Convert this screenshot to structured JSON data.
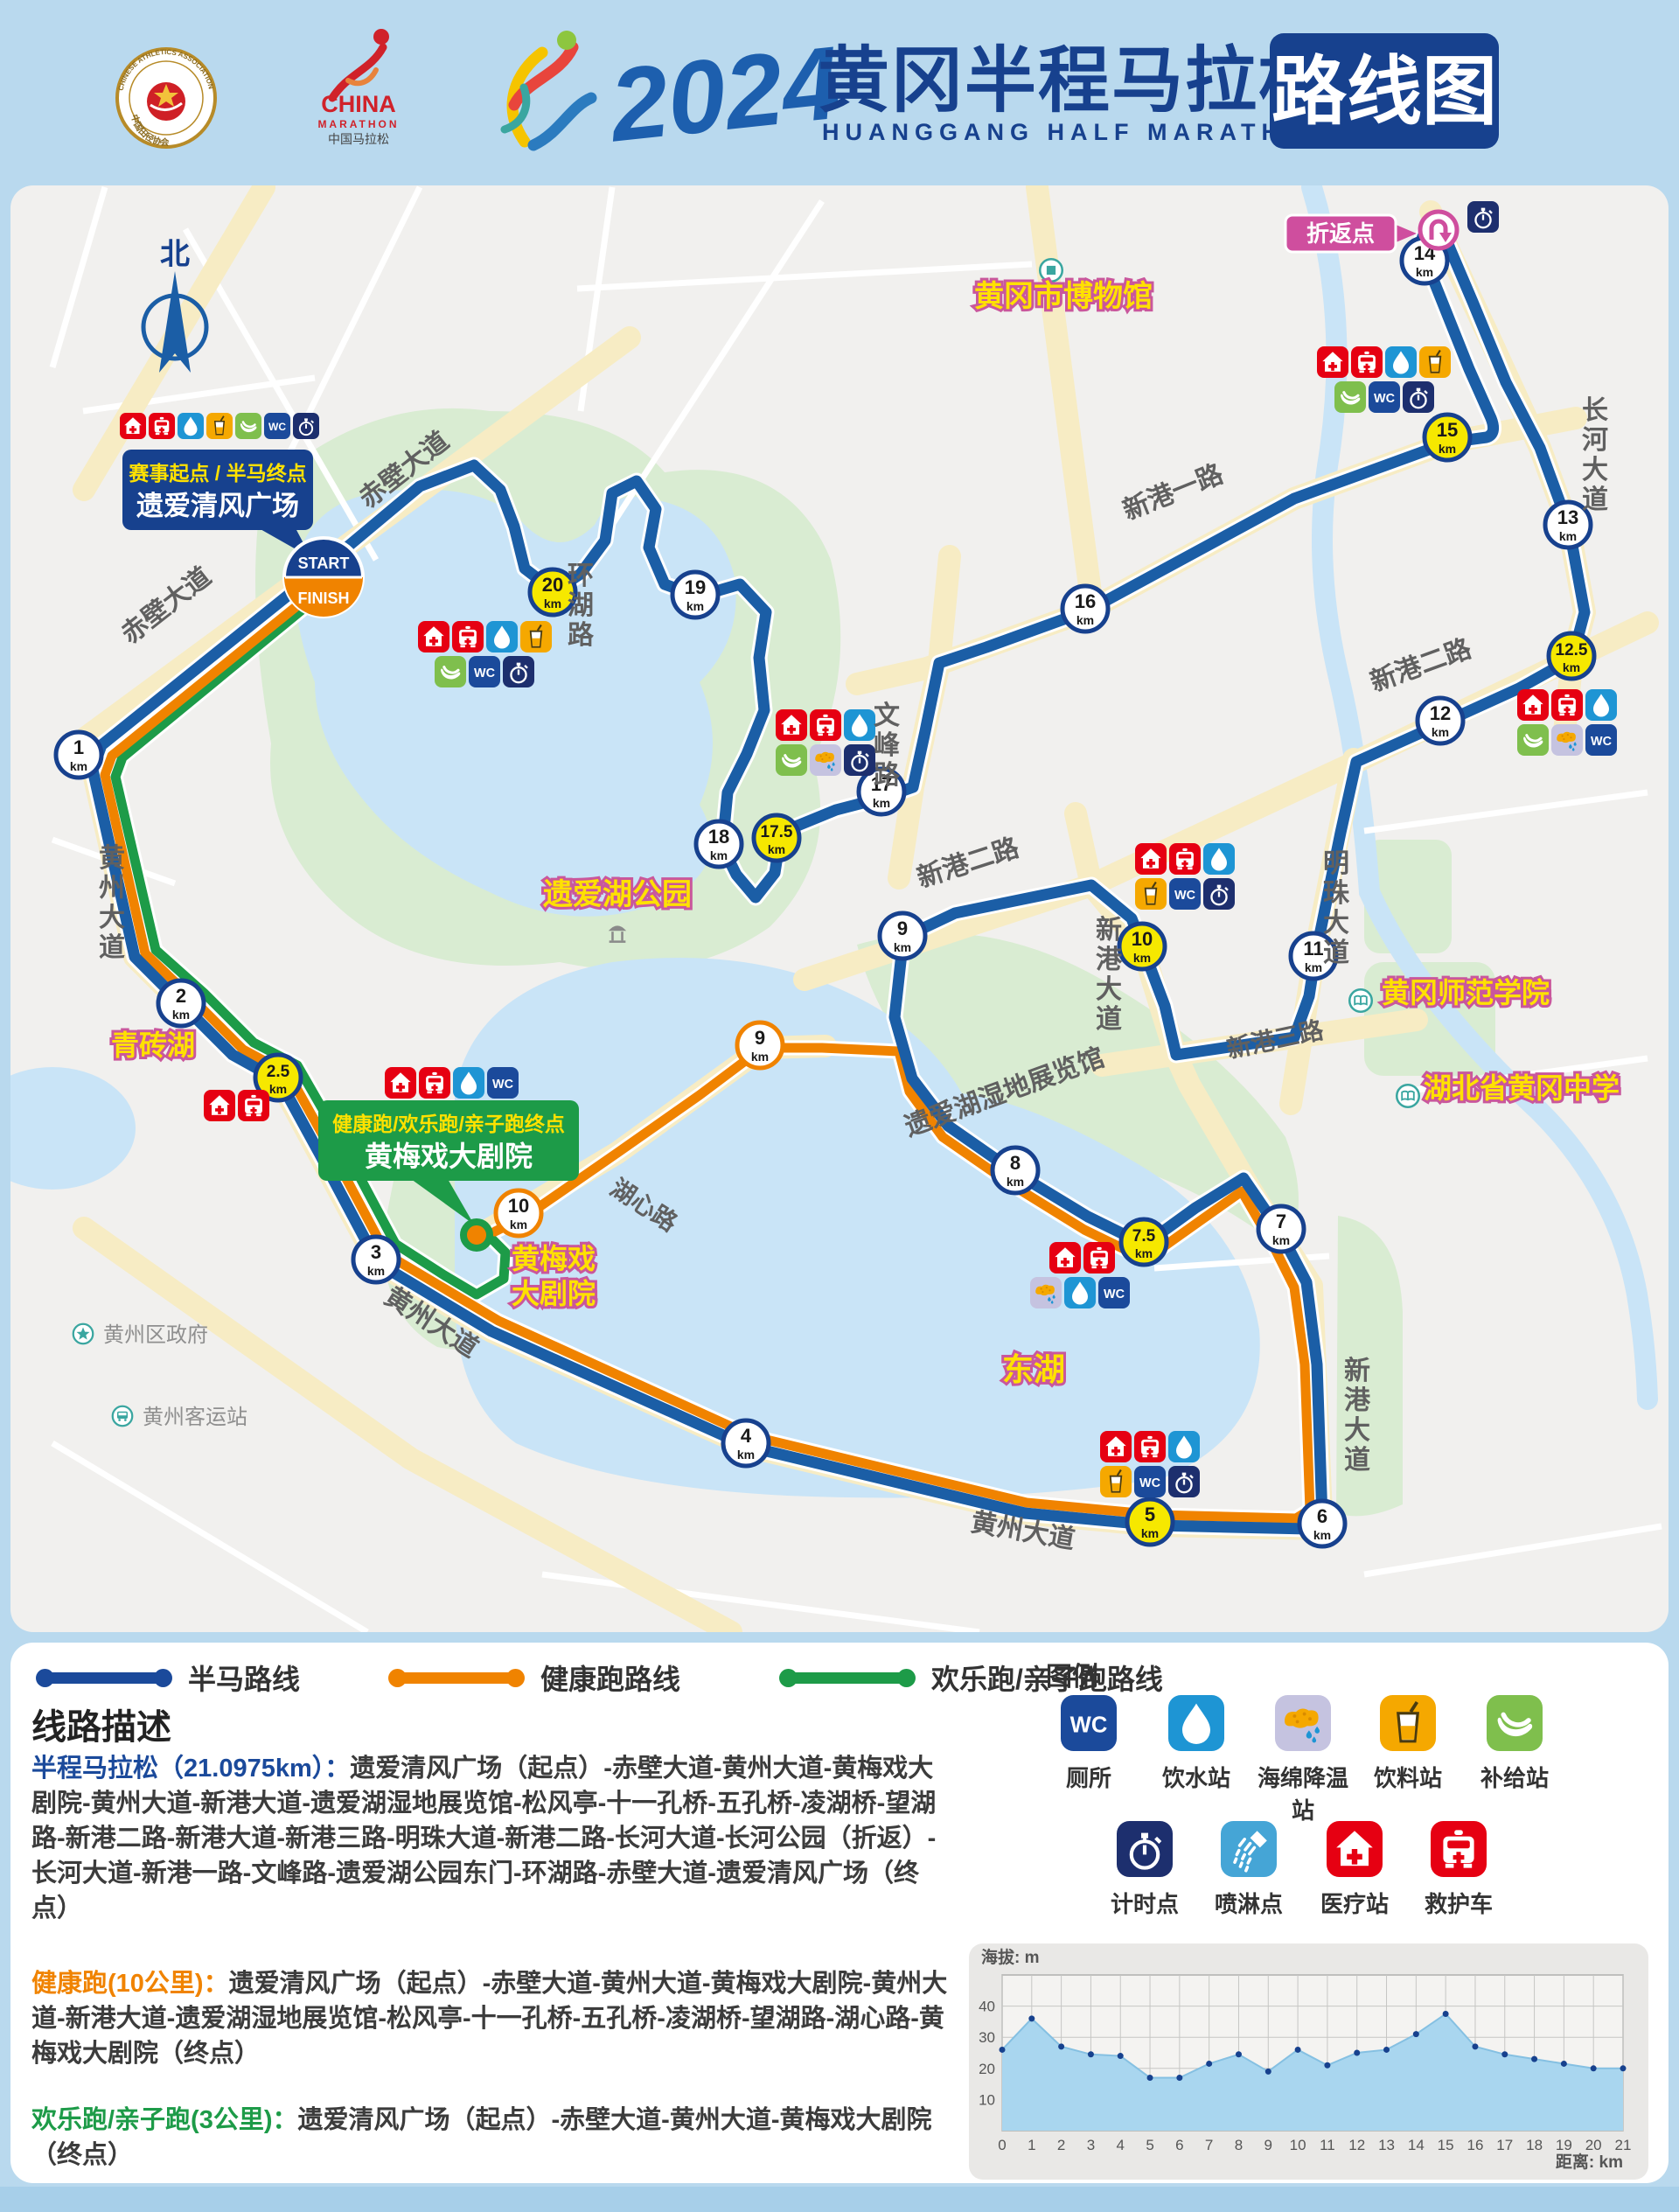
{
  "header": {
    "caa": {
      "top": "CHINESE ATHLETICS ASSOCIATION",
      "bottom": "中国田径协会"
    },
    "cm": {
      "l1": "CHINA",
      "l2": "MARATHON",
      "l3": "中国马拉松"
    },
    "year": "2024",
    "title_cn": "黄冈半程马拉松",
    "title_en": "HUANGGANG HALF MARATHON",
    "badge": "路线图"
  },
  "icons": {
    "wc_label": "WC"
  },
  "map": {
    "compass": "北",
    "start_label": {
      "line1": "赛事起点 / 半马终点",
      "line2": "遗爱清风广场"
    },
    "start_badge": {
      "top": "START",
      "bottom": "FINISH"
    },
    "turnaround_label": "折返点",
    "finish_label": {
      "line1": "健康跑/欢乐跑/亲子跑终点",
      "line2": "黄梅戏大剧院"
    },
    "km_unit": "km",
    "marker_styles": {
      "white": {
        "fill": "#ffffff",
        "stroke": "#17418e"
      },
      "yellow": {
        "fill": "#f6e800",
        "stroke": "#17418e"
      },
      "orange": {
        "fill": "#ffffff",
        "stroke": "#f08300"
      }
    },
    "km_markers": [
      {
        "num": "1",
        "x": 90,
        "y": 863,
        "style": "white"
      },
      {
        "num": "2",
        "x": 207,
        "y": 1147,
        "style": "white"
      },
      {
        "num": "2.5",
        "x": 318,
        "y": 1232,
        "style": "yellow"
      },
      {
        "num": "3",
        "x": 430,
        "y": 1440,
        "style": "white"
      },
      {
        "num": "4",
        "x": 853,
        "y": 1650,
        "style": "white"
      },
      {
        "num": "5",
        "x": 1315,
        "y": 1740,
        "style": "yellow"
      },
      {
        "num": "6",
        "x": 1512,
        "y": 1742,
        "style": "white"
      },
      {
        "num": "7",
        "x": 1465,
        "y": 1405,
        "style": "white"
      },
      {
        "num": "7.5",
        "x": 1308,
        "y": 1420,
        "style": "yellow"
      },
      {
        "num": "8",
        "x": 1161,
        "y": 1338,
        "style": "white"
      },
      {
        "num": "9",
        "x": 1032,
        "y": 1070,
        "style": "white"
      },
      {
        "num": "9",
        "x": 869,
        "y": 1195,
        "style": "orange"
      },
      {
        "num": "10",
        "x": 1306,
        "y": 1082,
        "style": "yellow"
      },
      {
        "num": "10",
        "x": 593,
        "y": 1387,
        "style": "orange"
      },
      {
        "num": "11",
        "x": 1502,
        "y": 1093,
        "style": "white"
      },
      {
        "num": "12",
        "x": 1647,
        "y": 824,
        "style": "white"
      },
      {
        "num": "12.5",
        "x": 1797,
        "y": 750,
        "style": "yellow"
      },
      {
        "num": "13",
        "x": 1793,
        "y": 600,
        "style": "white"
      },
      {
        "num": "14",
        "x": 1629,
        "y": 298,
        "style": "white"
      },
      {
        "num": "15",
        "x": 1655,
        "y": 500,
        "style": "yellow"
      },
      {
        "num": "16",
        "x": 1241,
        "y": 696,
        "style": "white"
      },
      {
        "num": "17",
        "x": 1008,
        "y": 905,
        "style": "white"
      },
      {
        "num": "17.5",
        "x": 888,
        "y": 958,
        "style": "yellow"
      },
      {
        "num": "18",
        "x": 822,
        "y": 965,
        "style": "white"
      },
      {
        "num": "19",
        "x": 795,
        "y": 680,
        "style": "white"
      },
      {
        "num": "20",
        "x": 632,
        "y": 677,
        "style": "yellow"
      }
    ],
    "clusters": [
      {
        "x": 137,
        "y": 472,
        "size": 30,
        "rows": [
          {
            "dx": 0,
            "icons": [
              "medical",
              "ambulance",
              "water",
              "drink",
              "banana",
              "wc",
              "timer"
            ]
          }
        ]
      },
      {
        "x": 478,
        "y": 710,
        "rows": [
          {
            "dx": 0,
            "icons": [
              "medical",
              "ambulance",
              "water",
              "drink"
            ]
          },
          {
            "dx": 19,
            "icons": [
              "banana",
              "wc",
              "timer"
            ]
          }
        ]
      },
      {
        "x": 887,
        "y": 811,
        "rows": [
          {
            "dx": 0,
            "icons": [
              "medical",
              "ambulance",
              "water"
            ]
          },
          {
            "dx": 0,
            "icons": [
              "banana",
              "sponge",
              "timer"
            ]
          }
        ]
      },
      {
        "x": 1506,
        "y": 396,
        "rows": [
          {
            "dx": 0,
            "icons": [
              "medical",
              "ambulance",
              "water",
              "drink"
            ]
          },
          {
            "dx": 20,
            "icons": [
              "banana",
              "wc",
              "timer"
            ]
          }
        ]
      },
      {
        "x": 1735,
        "y": 788,
        "rows": [
          {
            "dx": 0,
            "icons": [
              "medical",
              "ambulance",
              "water"
            ]
          },
          {
            "dx": 0,
            "icons": [
              "banana",
              "sponge",
              "wc"
            ]
          }
        ]
      },
      {
        "x": 1298,
        "y": 964,
        "rows": [
          {
            "dx": 0,
            "icons": [
              "medical",
              "ambulance",
              "water"
            ]
          },
          {
            "dx": 0,
            "icons": [
              "drink",
              "wc",
              "timer"
            ]
          }
        ]
      },
      {
        "x": 1200,
        "y": 1420,
        "rows": [
          {
            "dx": 0,
            "icons": [
              "medical",
              "ambulance"
            ]
          },
          {
            "dx": -22,
            "icons": [
              "sponge",
              "water",
              "wc"
            ]
          }
        ]
      },
      {
        "x": 1258,
        "y": 1636,
        "rows": [
          {
            "dx": 0,
            "icons": [
              "medical",
              "ambulance",
              "water"
            ]
          },
          {
            "dx": 0,
            "icons": [
              "drink",
              "wc",
              "timer"
            ]
          }
        ]
      },
      {
        "x": 440,
        "y": 1220,
        "rows": [
          {
            "dx": 0,
            "icons": [
              "medical",
              "ambulance",
              "water",
              "wc"
            ]
          }
        ]
      },
      {
        "x": 233,
        "y": 1246,
        "rows": [
          {
            "dx": 0,
            "icons": [
              "medical",
              "ambulance"
            ]
          }
        ]
      },
      {
        "x": 1678,
        "y": 230,
        "rows": [
          {
            "dx": 0,
            "icons": [
              "timer"
            ]
          }
        ]
      }
    ],
    "road_labels": [
      {
        "t": "赤壁大道",
        "x": 468,
        "y": 545,
        "rot": -38,
        "s": 30
      },
      {
        "t": "赤壁大道",
        "x": 196,
        "y": 700,
        "rot": -38,
        "s": 30
      },
      {
        "t": "黄州大道",
        "x": 128,
        "y": 1042,
        "v": 1,
        "s": 30
      },
      {
        "t": "环湖路",
        "x": 664,
        "y": 702,
        "v": 1,
        "s": 30
      },
      {
        "t": "文峰路",
        "x": 1014,
        "y": 862,
        "v": 1,
        "s": 30
      },
      {
        "t": "新港一路",
        "x": 1345,
        "y": 572,
        "rot": -22,
        "s": 30
      },
      {
        "t": "长河大道",
        "x": 1824,
        "y": 530,
        "v": 1,
        "s": 30
      },
      {
        "t": "新港二路",
        "x": 1628,
        "y": 770,
        "rot": -20,
        "s": 30
      },
      {
        "t": "新港二路",
        "x": 1110,
        "y": 996,
        "rot": -18,
        "s": 30
      },
      {
        "t": "明珠大道",
        "x": 1528,
        "y": 1048,
        "v": 1,
        "s": 30
      },
      {
        "t": "新港三路",
        "x": 1460,
        "y": 1198,
        "rot": -12,
        "s": 28
      },
      {
        "t": "新港大道",
        "x": 1268,
        "y": 1124,
        "v": 1,
        "s": 30
      },
      {
        "t": "新港大道",
        "x": 1552,
        "y": 1628,
        "v": 1,
        "s": 30
      },
      {
        "t": "湖心路",
        "x": 731,
        "y": 1386,
        "rot": 33,
        "s": 28
      },
      {
        "t": "黄州大道",
        "x": 1168,
        "y": 1760,
        "rot": 10,
        "s": 30
      },
      {
        "t": "黄州大道",
        "x": 488,
        "y": 1520,
        "rot": 33,
        "s": 30
      },
      {
        "t": "遗爱湖湿地展览馆",
        "x": 1152,
        "y": 1258,
        "rot": -20,
        "s": 30
      }
    ],
    "landmarks": [
      {
        "t": "黄冈市博物馆",
        "x": 1216,
        "y": 350,
        "s": 34,
        "icon": "museum",
        "ix": 1202,
        "iy": 309
      },
      {
        "t": "遗爱湖公园",
        "x": 706,
        "y": 1034,
        "s": 34,
        "icon": "pavilion",
        "ix": 706,
        "iy": 1066
      },
      {
        "t": "青砖湖",
        "x": 175,
        "y": 1206,
        "s": 32
      },
      {
        "t": "黄梅戏",
        "x": 633,
        "y": 1450,
        "s": 32
      },
      {
        "t": "大剧院",
        "x": 633,
        "y": 1490,
        "s": 32
      },
      {
        "t": "东湖",
        "x": 1182,
        "y": 1578,
        "s": 36
      },
      {
        "t": "黄冈师范学院",
        "x": 1676,
        "y": 1146,
        "s": 32,
        "icon": "school",
        "ix": 1556,
        "iy": 1144
      },
      {
        "t": "湖北省黄冈中学",
        "x": 1740,
        "y": 1255,
        "s": 32,
        "icon": "school",
        "ix": 1610,
        "iy": 1253
      }
    ],
    "pois": [
      {
        "t": "黄州区政府",
        "x": 118,
        "y": 1534,
        "icon": "star",
        "ix": 95,
        "iy": 1525
      },
      {
        "t": "黄州客运站",
        "x": 163,
        "y": 1628,
        "icon": "buspoi",
        "ix": 140,
        "iy": 1619
      }
    ]
  },
  "legend_routes": [
    {
      "label": "半马路线",
      "color": "#1b4a9b",
      "x": 45
    },
    {
      "label": "健康跑路线",
      "color": "#f08300",
      "x": 448
    },
    {
      "label": "欢乐跑/亲子跑路线",
      "color": "#1d9b48",
      "x": 895
    }
  ],
  "description": {
    "heading": "线路描述",
    "items": [
      {
        "lead": "半程马拉松（21.0975km）：",
        "color": "#1b4a9b",
        "text": "遗爱清风广场（起点）-赤壁大道-黄州大道-黄梅戏大剧院-黄州大道-新港大道-遗爱湖湿地展览馆-松风亭-十一孔桥-五孔桥-凌湖桥-望湖路-新港二路-新港大道-新港三路-明珠大道-新港二路-长河大道-长河公园（折返）-长河大道-新港一路-文峰路-遗爱湖公园东门-环湖路-赤壁大道-遗爱清风广场（终点）"
      },
      {
        "lead": "健康跑(10公里)：",
        "color": "#f08300",
        "text": "遗爱清风广场（起点）-赤壁大道-黄州大道-黄梅戏大剧院-黄州大道-新港大道-遗爱湖湿地展览馆-松风亭-十一孔桥-五孔桥-凌湖桥-望湖路-湖心路-黄梅戏大剧院（终点）"
      },
      {
        "lead": "欢乐跑/亲子跑(3公里)：",
        "color": "#1d9b48",
        "text": "遗爱清风广场（起点）-赤壁大道-黄州大道-黄梅戏大剧院（终点）"
      }
    ]
  },
  "facility_legend": {
    "title": "图例",
    "rows": [
      [
        {
          "icon": "wc",
          "label": "厕所"
        },
        {
          "icon": "water",
          "label": "饮水站"
        },
        {
          "icon": "sponge",
          "label": "海绵降温站"
        },
        {
          "icon": "drink",
          "label": "饮料站"
        },
        {
          "icon": "banana",
          "label": "补给站"
        }
      ],
      [
        {
          "icon": "timer",
          "label": "计时点"
        },
        {
          "icon": "spray",
          "label": "喷淋点"
        },
        {
          "icon": "medical",
          "label": "医疗站"
        },
        {
          "icon": "ambulance",
          "label": "救护车"
        }
      ]
    ]
  },
  "chart_data": {
    "type": "area",
    "ylabel": "海拔: m",
    "xlabel": "距离: km",
    "x": [
      0,
      1,
      2,
      3,
      4,
      5,
      6,
      7,
      8,
      9,
      10,
      11,
      12,
      13,
      14,
      15,
      16,
      17,
      18,
      19,
      20,
      21
    ],
    "values": [
      26,
      36,
      27,
      24.5,
      24,
      17,
      17,
      21.5,
      24.5,
      19,
      26,
      21,
      25,
      26,
      31,
      37.5,
      27,
      24.5,
      23,
      21.5,
      20,
      20
    ],
    "yticks": [
      10,
      20,
      30,
      40
    ],
    "ylim": [
      0,
      50
    ],
    "grid": true,
    "fill_color": "#a9d6ef",
    "line_color": "#85c0e2",
    "dot_color": "#17418e"
  }
}
